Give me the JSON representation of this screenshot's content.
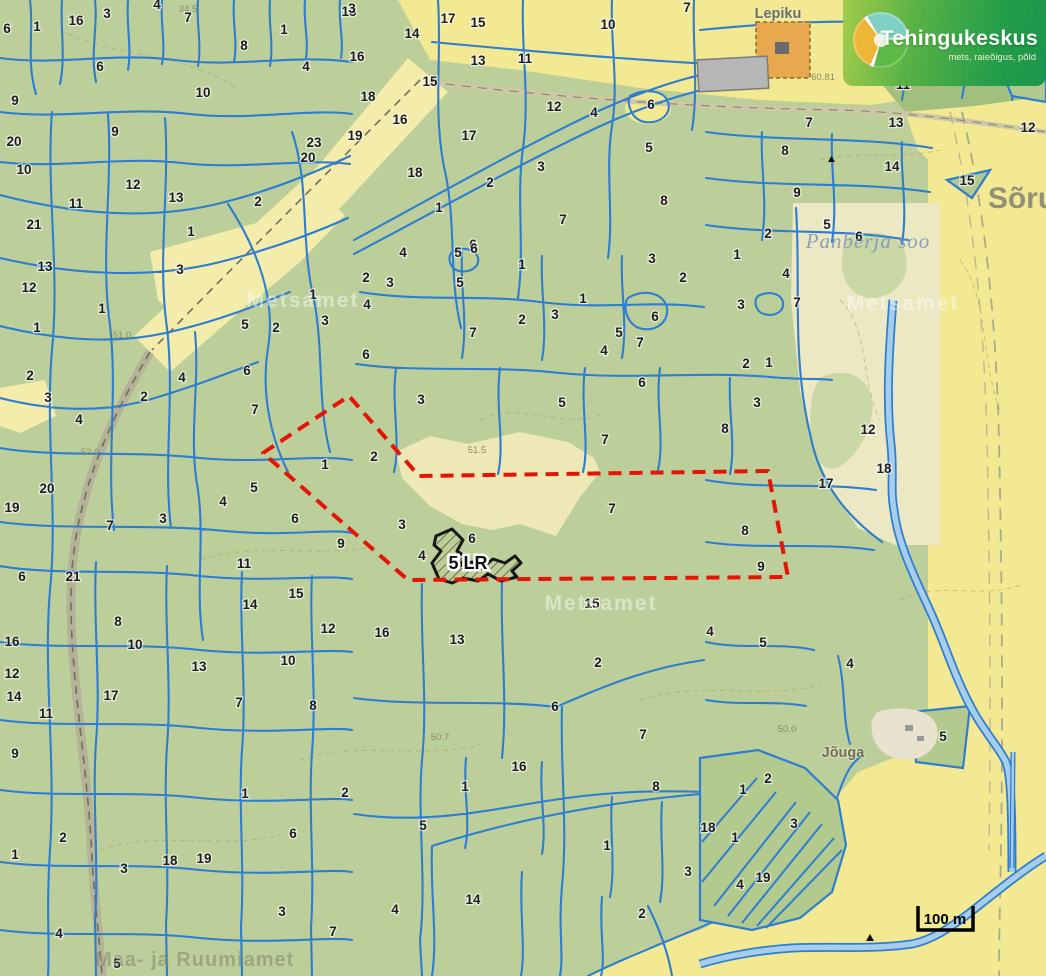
{
  "branding": {
    "name": "Tehingukeskus",
    "tagline": "mets, raieõigus, põld"
  },
  "scale_bar": {
    "label": "100 m"
  },
  "selection": {
    "label": "5 LR"
  },
  "colors": {
    "forest_green": "#bccf9a",
    "field_yellow": "#f3e992",
    "marsh_cream": "#ece8c3",
    "parcel_line_blue": "#2e7dd1",
    "boundary_red": "#e31507",
    "water_fill": "#a6cdec",
    "logo_green": "#2ba149",
    "logo_teal": "#7fd2c6",
    "logo_amber": "#f2b634",
    "farmstead_orange": "#e8a84e"
  },
  "map_texts": [
    {
      "class": "num",
      "name": "parcel-number",
      "items": [
        [
          7,
          33,
          "6"
        ],
        [
          37,
          31,
          "1"
        ],
        [
          76,
          25,
          "16"
        ],
        [
          107,
          18,
          "3"
        ],
        [
          157,
          9,
          "4"
        ],
        [
          188,
          22,
          "7"
        ],
        [
          244,
          50,
          "8"
        ],
        [
          284,
          34,
          "1"
        ],
        [
          306,
          71,
          "4"
        ],
        [
          100,
          71,
          "6"
        ],
        [
          15,
          105,
          "9"
        ],
        [
          203,
          97,
          "10"
        ],
        [
          14,
          146,
          "20"
        ],
        [
          115,
          136,
          "9"
        ],
        [
          314,
          147,
          "23"
        ],
        [
          308,
          162,
          "20"
        ],
        [
          24,
          174,
          "10"
        ],
        [
          133,
          189,
          "12"
        ],
        [
          176,
          202,
          "13"
        ],
        [
          76,
          208,
          "11"
        ],
        [
          258,
          206,
          "2"
        ],
        [
          34,
          229,
          "21"
        ],
        [
          191,
          236,
          "1"
        ],
        [
          349,
          16,
          "13"
        ],
        [
          352,
          13,
          "3"
        ],
        [
          448,
          23,
          "17"
        ],
        [
          478,
          27,
          "15"
        ],
        [
          412,
          38,
          "14"
        ],
        [
          608,
          29,
          "10"
        ],
        [
          687,
          12,
          "7"
        ],
        [
          357,
          61,
          "16"
        ],
        [
          478,
          65,
          "13"
        ],
        [
          525,
          63,
          "11"
        ],
        [
          430,
          86,
          "15"
        ],
        [
          368,
          101,
          "18"
        ],
        [
          400,
          124,
          "16"
        ],
        [
          554,
          111,
          "12"
        ],
        [
          594,
          117,
          "4"
        ],
        [
          651,
          109,
          "6"
        ],
        [
          355,
          140,
          "19"
        ],
        [
          469,
          140,
          "17"
        ],
        [
          649,
          152,
          "5"
        ],
        [
          415,
          177,
          "18"
        ],
        [
          490,
          187,
          "2"
        ],
        [
          541,
          171,
          "3"
        ],
        [
          664,
          205,
          "8"
        ],
        [
          439,
          212,
          "1"
        ],
        [
          563,
          224,
          "7"
        ],
        [
          473,
          249,
          "6"
        ],
        [
          945,
          23,
          "10"
        ],
        [
          903,
          89,
          "11"
        ],
        [
          974,
          77,
          "12"
        ],
        [
          1007,
          80,
          "11"
        ],
        [
          809,
          127,
          "7"
        ],
        [
          896,
          127,
          "13"
        ],
        [
          1028,
          132,
          "12"
        ],
        [
          785,
          155,
          "8"
        ],
        [
          892,
          171,
          "14"
        ],
        [
          967,
          185,
          "15"
        ],
        [
          797,
          197,
          "9"
        ],
        [
          768,
          238,
          "2"
        ],
        [
          827,
          229,
          "5"
        ],
        [
          859,
          241,
          "6"
        ],
        [
          1032,
          17,
          "13"
        ],
        [
          45,
          271,
          "13"
        ],
        [
          29,
          292,
          "12"
        ],
        [
          102,
          313,
          "1"
        ],
        [
          180,
          274,
          "3"
        ],
        [
          37,
          332,
          "1"
        ],
        [
          313,
          299,
          "1"
        ],
        [
          325,
          325,
          "3"
        ],
        [
          245,
          329,
          "5"
        ],
        [
          276,
          332,
          "2"
        ],
        [
          30,
          380,
          "2"
        ],
        [
          182,
          382,
          "4"
        ],
        [
          247,
          375,
          "6"
        ],
        [
          48,
          402,
          "3"
        ],
        [
          144,
          401,
          "2"
        ],
        [
          255,
          414,
          "7"
        ],
        [
          79,
          424,
          "4"
        ],
        [
          325,
          469,
          "1"
        ],
        [
          47,
          493,
          "20"
        ],
        [
          254,
          492,
          "5"
        ],
        [
          403,
          257,
          "4"
        ],
        [
          458,
          257,
          "5"
        ],
        [
          474,
          253,
          "6"
        ],
        [
          522,
          269,
          "1"
        ],
        [
          652,
          263,
          "3"
        ],
        [
          683,
          282,
          "2"
        ],
        [
          366,
          282,
          "2"
        ],
        [
          390,
          287,
          "3"
        ],
        [
          460,
          287,
          "5"
        ],
        [
          367,
          309,
          "4"
        ],
        [
          583,
          303,
          "1"
        ],
        [
          555,
          319,
          "3"
        ],
        [
          522,
          324,
          "2"
        ],
        [
          655,
          321,
          "6"
        ],
        [
          619,
          337,
          "5"
        ],
        [
          640,
          347,
          "7"
        ],
        [
          473,
          337,
          "7"
        ],
        [
          604,
          355,
          "4"
        ],
        [
          366,
          359,
          "6"
        ],
        [
          642,
          387,
          "6"
        ],
        [
          421,
          404,
          "3"
        ],
        [
          562,
          407,
          "5"
        ],
        [
          605,
          444,
          "7"
        ],
        [
          374,
          461,
          "2"
        ],
        [
          737,
          259,
          "1"
        ],
        [
          786,
          278,
          "4"
        ],
        [
          741,
          309,
          "3"
        ],
        [
          797,
          307,
          "7"
        ],
        [
          746,
          368,
          "2"
        ],
        [
          769,
          367,
          "1"
        ],
        [
          757,
          407,
          "3"
        ],
        [
          725,
          433,
          "8"
        ],
        [
          868,
          434,
          "12"
        ],
        [
          884,
          473,
          "18"
        ],
        [
          826,
          488,
          "17"
        ],
        [
          12,
          512,
          "19"
        ],
        [
          110,
          530,
          "7"
        ],
        [
          163,
          523,
          "3"
        ],
        [
          223,
          506,
          "4"
        ],
        [
          295,
          523,
          "6"
        ],
        [
          341,
          548,
          "9"
        ],
        [
          22,
          581,
          "6"
        ],
        [
          73,
          581,
          "21"
        ],
        [
          244,
          568,
          "11"
        ],
        [
          250,
          609,
          "14"
        ],
        [
          296,
          598,
          "15"
        ],
        [
          118,
          626,
          "8"
        ],
        [
          135,
          649,
          "10"
        ],
        [
          328,
          633,
          "12"
        ],
        [
          12,
          646,
          "16"
        ],
        [
          199,
          671,
          "13"
        ],
        [
          288,
          665,
          "10"
        ],
        [
          12,
          678,
          "12"
        ],
        [
          14,
          701,
          "14"
        ],
        [
          111,
          700,
          "17"
        ],
        [
          239,
          707,
          "7"
        ],
        [
          313,
          710,
          "8"
        ],
        [
          46,
          718,
          "11"
        ],
        [
          402,
          529,
          "3"
        ],
        [
          472,
          543,
          "6"
        ],
        [
          422,
          560,
          "4"
        ],
        [
          612,
          513,
          "7"
        ],
        [
          592,
          608,
          "15"
        ],
        [
          382,
          637,
          "16"
        ],
        [
          457,
          644,
          "13"
        ],
        [
          598,
          667,
          "2"
        ],
        [
          555,
          711,
          "6"
        ],
        [
          643,
          739,
          "7"
        ],
        [
          745,
          535,
          "8"
        ],
        [
          761,
          571,
          "9"
        ],
        [
          710,
          636,
          "4"
        ],
        [
          763,
          647,
          "5"
        ],
        [
          850,
          668,
          "4"
        ],
        [
          943,
          741,
          "5"
        ],
        [
          15,
          758,
          "9"
        ],
        [
          245,
          798,
          "1"
        ],
        [
          345,
          797,
          "2"
        ],
        [
          63,
          842,
          "2"
        ],
        [
          293,
          838,
          "6"
        ],
        [
          15,
          859,
          "1"
        ],
        [
          124,
          873,
          "3"
        ],
        [
          170,
          865,
          "18"
        ],
        [
          204,
          863,
          "19"
        ],
        [
          282,
          916,
          "3"
        ],
        [
          59,
          938,
          "4"
        ],
        [
          333,
          936,
          "7"
        ],
        [
          117,
          968,
          "5"
        ],
        [
          519,
          771,
          "16"
        ],
        [
          465,
          791,
          "1"
        ],
        [
          656,
          791,
          "8"
        ],
        [
          423,
          830,
          "5"
        ],
        [
          607,
          850,
          "1"
        ],
        [
          688,
          876,
          "3"
        ],
        [
          473,
          904,
          "14"
        ],
        [
          395,
          914,
          "4"
        ],
        [
          642,
          918,
          "2"
        ],
        [
          768,
          783,
          "2"
        ],
        [
          743,
          794,
          "1"
        ],
        [
          794,
          828,
          "3"
        ],
        [
          708,
          832,
          "18"
        ],
        [
          735,
          842,
          "1"
        ],
        [
          763,
          882,
          "19"
        ],
        [
          740,
          889,
          "4"
        ]
      ]
    },
    {
      "class": "place",
      "name": "place-label",
      "items": [
        [
          778,
          18,
          "Lepiku"
        ],
        [
          843,
          757,
          "Jõuga"
        ]
      ]
    },
    {
      "class": "place-big",
      "name": "place-label-large",
      "items": [
        [
          1022,
          208,
          "Sõru"
        ]
      ]
    },
    {
      "class": "marsh",
      "name": "marsh-label",
      "items": [
        [
          868,
          248,
          "Panberja soo"
        ]
      ]
    },
    {
      "class": "wm-white",
      "name": "watermark",
      "items": [
        [
          303,
          307,
          "Metsamet"
        ],
        [
          601,
          610,
          "Metsamet"
        ],
        [
          903,
          310,
          "Metsamet"
        ]
      ]
    },
    {
      "class": "wm-gray",
      "name": "agency-watermark",
      "items": [
        [
          95,
          966,
          "Maa- ja Ruumiamet"
        ]
      ]
    },
    {
      "class": "elev",
      "name": "elevation-label",
      "items": [
        [
          823,
          80,
          "60.81"
        ],
        [
          188,
          12,
          "34.5"
        ],
        [
          122,
          338,
          "51.0"
        ],
        [
          477,
          453,
          "51.5"
        ],
        [
          440,
          740,
          "50.7"
        ],
        [
          787,
          732,
          "50.0"
        ],
        [
          90,
          455,
          "52.0"
        ]
      ]
    },
    {
      "class": "sel",
      "name": "selected-parcel-label",
      "items": [
        [
          468,
          569,
          "5 LR"
        ]
      ]
    },
    {
      "class": "scale",
      "name": "scale-label",
      "items": [
        [
          945,
          924,
          "100 m"
        ]
      ]
    }
  ]
}
